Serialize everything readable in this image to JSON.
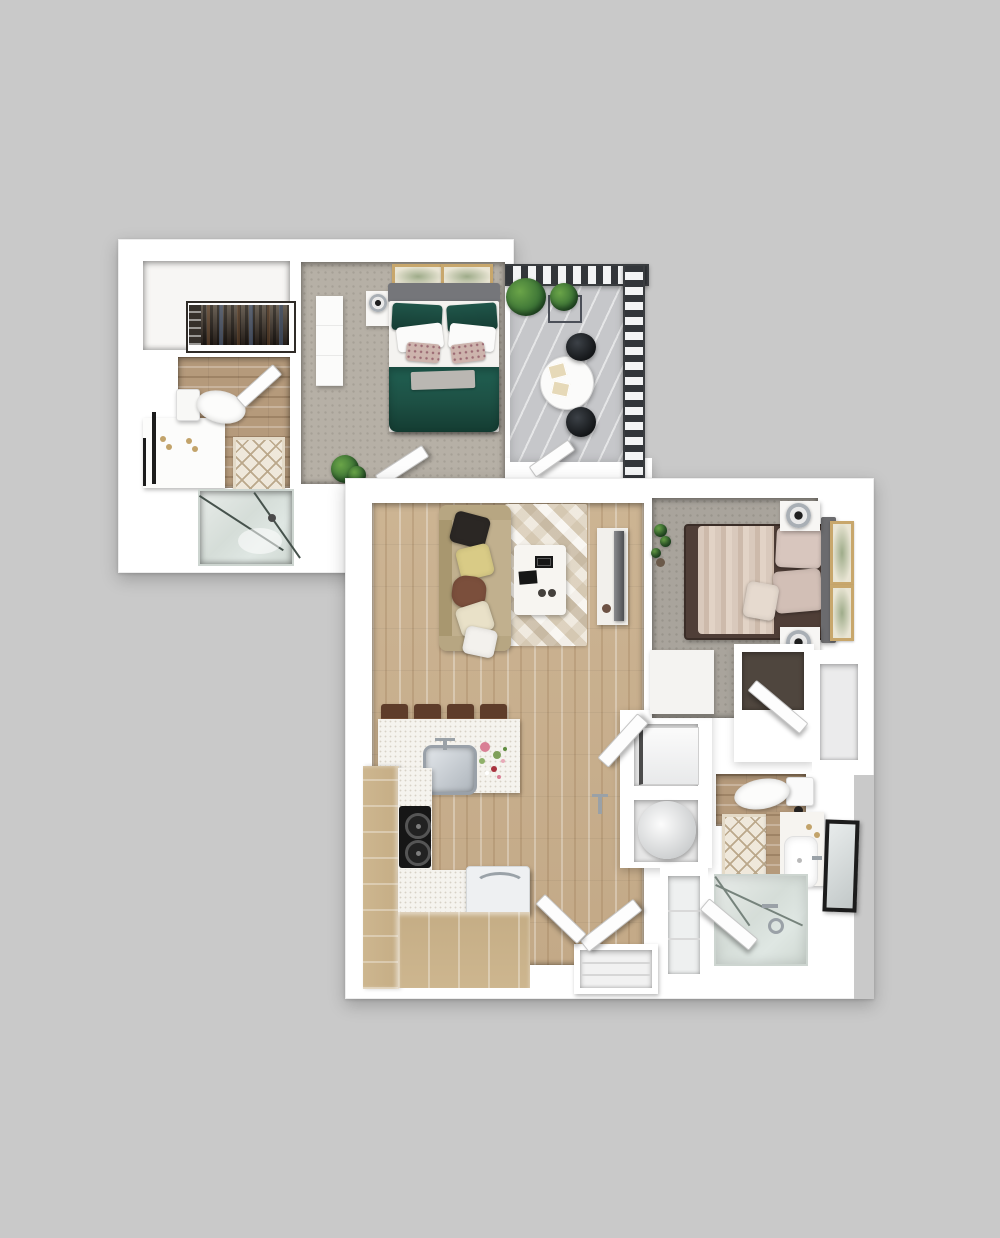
{
  "scene": {
    "type": "3d-floor-plan-render",
    "description": "Top-down 3D render of two overlapping apartment floor plans on a gray backdrop",
    "background_color": "#c9c9c9"
  },
  "palette": {
    "background": "#c9c9c9",
    "wall_white": "#ffffff",
    "carpet_upper": "#b6b0a6",
    "carpet_lower": "#a9a49c",
    "wood_floor": "#ccb493",
    "wood_bath": "#b59a7b",
    "cabinet_wood": "#c5ad85",
    "countertop": "#f5f3ee",
    "rug_base": "#e7e0d4",
    "sofa_tan": "#c1b08e",
    "bed_green": "#1d5044",
    "bed_fold_gray": "#bab7b2",
    "headboard_gray": "#75767a",
    "bed2_brown": "#4f3e37",
    "blanket_blush": "#d9c9bc",
    "pillow_blush": "#d8c6be",
    "deck_gray": "#c6c7ca",
    "railing_dark": "#33363a",
    "plant_green": "#2f6631",
    "glass_green": "#dfe7e3",
    "mirror_black": "#1c1c1c",
    "mat_cream": "#efe8db",
    "mat_line": "#bba88b",
    "frame_tan": "#c8a76c",
    "cooktop_black": "#161616",
    "steel": "#aeb5bc",
    "gold": "#c2a36a",
    "pillow_black": "#2b2724",
    "pillow_yellow": "#d9cb86",
    "pillow_brown": "#7b4f3c",
    "pillow_cream": "#e9e1c8",
    "tv_dark": "#4e4f52",
    "stool_brown": "#8a5d40",
    "appliance_white": "#f4f4f4",
    "flower_pink": "#d97f95",
    "flower_red": "#a8323e"
  },
  "upper_unit": {
    "rooms": [
      "walk-in-closet",
      "bathroom",
      "shower",
      "bedroom",
      "entry-hall"
    ],
    "furniture": [
      "clothes-rack",
      "toilet",
      "vanity-sink",
      "bath-mat",
      "glass-shower",
      "green-queen-bed",
      "gray-headboard",
      "wardrobe",
      "nightstand",
      "table-lamp",
      "two-wall-art-frames",
      "potted-plant",
      "swing-doors"
    ]
  },
  "balcony": {
    "furniture": [
      "metal-railing",
      "deck-planks",
      "two-potted-plants",
      "planter-box",
      "round-patio-table",
      "two-patio-chairs",
      "balcony-door"
    ]
  },
  "lower_unit": {
    "rooms": [
      "living-room",
      "kitchen",
      "hallway",
      "laundry-closet",
      "bedroom",
      "bathroom",
      "bedroom-closet",
      "linen-closet",
      "entry"
    ],
    "furniture": [
      "tan-sofa-with-pillows",
      "geometric-rug",
      "coffee-table",
      "tv-console",
      "television",
      "four-bar-stools",
      "kitchen-island",
      "sink",
      "flower-vase",
      "cooktop",
      "refrigerator",
      "cabinets",
      "washer",
      "dryer",
      "brown-bed",
      "blush-blanket",
      "two-nightstands",
      "two-lamps",
      "two-wall-art-frames",
      "dresser",
      "closet-shelves",
      "toilet",
      "vanity-sink",
      "leaning-mirror",
      "bath-mat",
      "bathtub",
      "swing-doors"
    ]
  }
}
